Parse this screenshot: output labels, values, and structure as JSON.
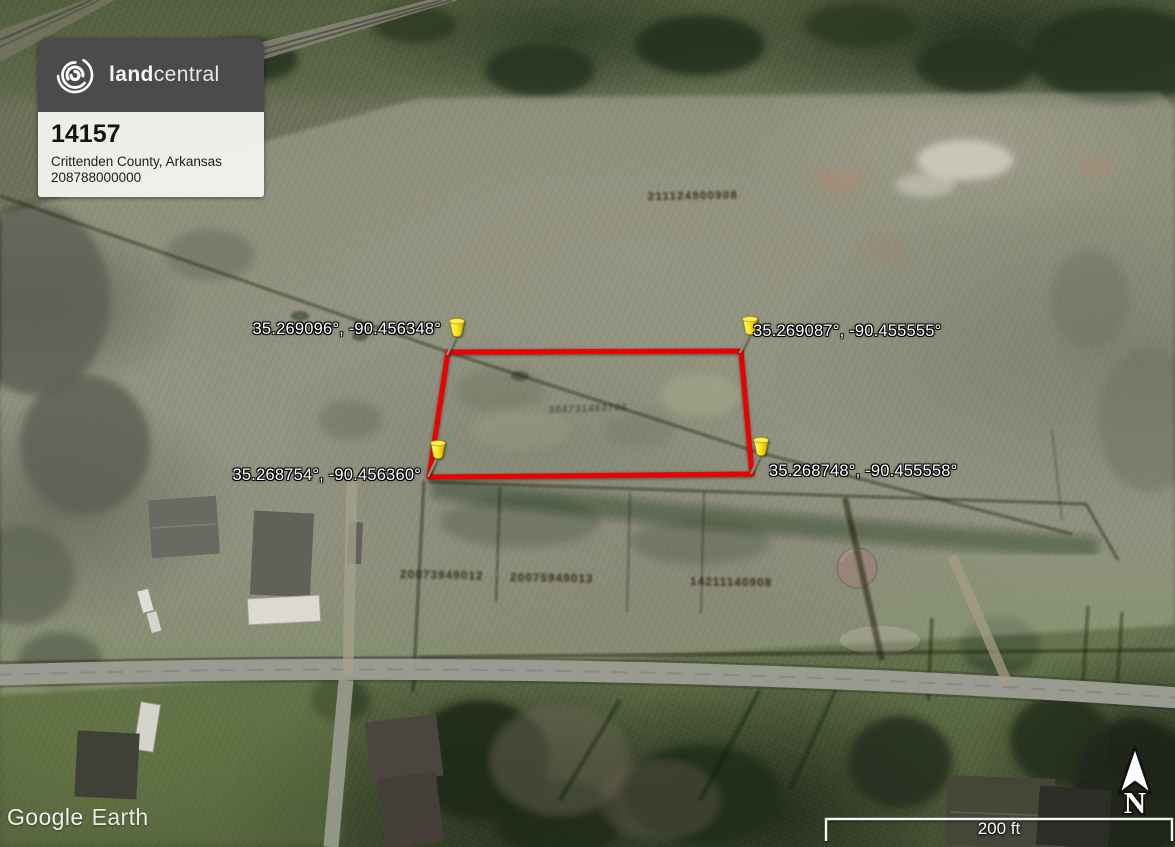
{
  "overlay_card": {
    "brand_bold": "land",
    "brand_light": "central",
    "property_id": "14157",
    "location": "Crittenden County, Arkansas",
    "parcel_number": "208788000000",
    "colors": {
      "header": "#4b4b4d",
      "body": "#f3f2ef"
    }
  },
  "parcel": {
    "outline_color": "#ee0000",
    "pin_color": "#ffe81a",
    "corners": [
      {
        "position": "northwest",
        "coordinates": "35.269096°, -90.456348°"
      },
      {
        "position": "northeast",
        "coordinates": "35.269087°, -90.455555°"
      },
      {
        "position": "southwest",
        "coordinates": "35.268754°, -90.456360°"
      },
      {
        "position": "southeast",
        "coordinates": "35.268748°, -90.455558°"
      }
    ]
  },
  "map": {
    "watermark_primary": "Google",
    "watermark_secondary": "Earth",
    "scale_label": "200 ft",
    "north_label": "N",
    "ground_labels": [
      {
        "text": "211124900908"
      },
      {
        "text": "308731403708"
      },
      {
        "text": "20073949012"
      },
      {
        "text": "20075949013"
      },
      {
        "text": "14211140908"
      }
    ]
  }
}
